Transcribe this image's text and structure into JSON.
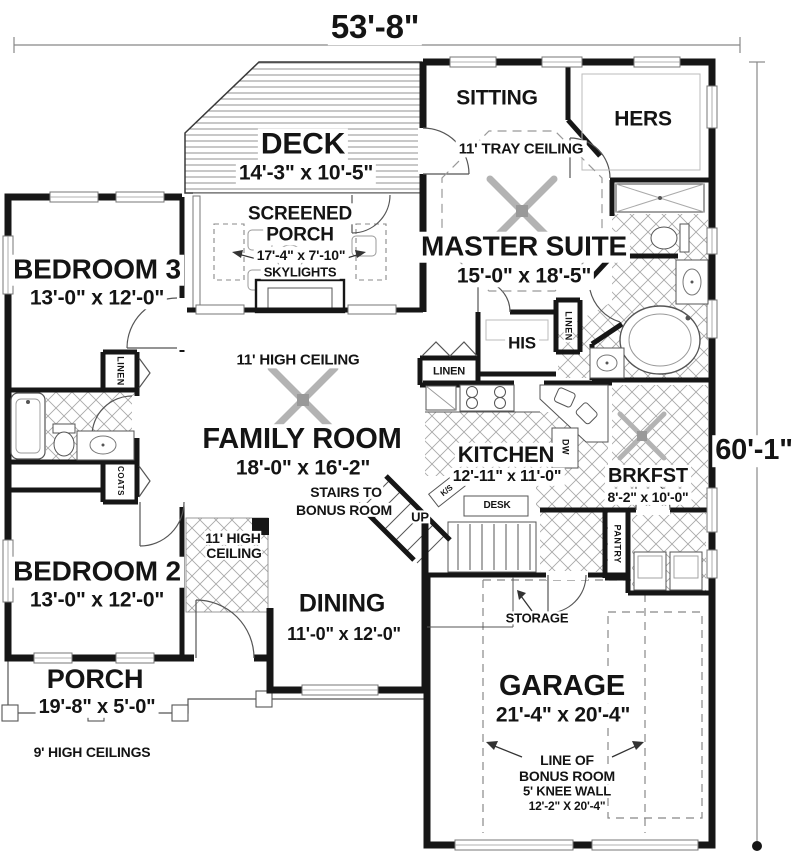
{
  "colors": {
    "wall": "#161616",
    "background": "#ffffff",
    "detail_line": "#555555",
    "tile_line": "#a8a8a8"
  },
  "dimensions": {
    "width": "53'-8\"",
    "height": "60'-1\""
  },
  "rooms": {
    "deck": {
      "name": "DECK",
      "dims": "14'-3\" x 10'-5\""
    },
    "screened_porch": {
      "name_line1": "SCREENED",
      "name_line2": "PORCH",
      "dims": "17'-4\" x 7'-10\"",
      "feature": "SKYLIGHTS"
    },
    "sitting": {
      "name": "SITTING"
    },
    "master_suite": {
      "name": "MASTER SUITE",
      "dims": "15'-0\" x 18'-5\"",
      "ceiling": "11' TRAY CEILING"
    },
    "hers_closet": {
      "name": "HERS"
    },
    "his_closet": {
      "name": "HIS"
    },
    "bedroom3": {
      "name": "BEDROOM 3",
      "dims": "13'-0\" x 12'-0\""
    },
    "bedroom2": {
      "name": "BEDROOM 2",
      "dims": "13'-0\" x 12'-0\""
    },
    "family_room": {
      "name": "FAMILY ROOM",
      "dims": "18'-0\" x 16'-2\"",
      "ceiling": "11' HIGH CEILING"
    },
    "kitchen": {
      "name": "KITCHEN",
      "dims": "12'-11\" x 11'-0\""
    },
    "breakfast": {
      "name": "BRKFST",
      "dims": "8'-2\" x 10'-0\""
    },
    "dining": {
      "name": "DINING",
      "dims": "11'-0\" x 12'-0\""
    },
    "garage": {
      "name": "GARAGE",
      "dims": "21'-4\" x 20'-4\""
    },
    "porch": {
      "name": "PORCH",
      "dims": "19'-8\" x 5'-0\"",
      "note": "9' HIGH CEILINGS"
    },
    "foyer": {
      "ceiling_line1": "11' HIGH",
      "ceiling_line2": "CEILING"
    },
    "storage": {
      "name": "STORAGE"
    }
  },
  "closets": {
    "linen_bedroom3": "LINEN",
    "linen_hall": "LINEN",
    "linen_master": "LINEN",
    "coats": "COATS",
    "pantry": "PANTRY"
  },
  "annotations": {
    "stairs_line1": "STAIRS TO",
    "stairs_line2": "BONUS ROOM",
    "up": "UP",
    "kitchen_sink": "K/S",
    "desk": "DESK",
    "dishwasher": "DW",
    "bonus_line1": "LINE OF",
    "bonus_line2": "BONUS ROOM",
    "bonus_line3": "5' KNEE WALL",
    "bonus_line4": "12'-2\" X 20'-4\""
  }
}
